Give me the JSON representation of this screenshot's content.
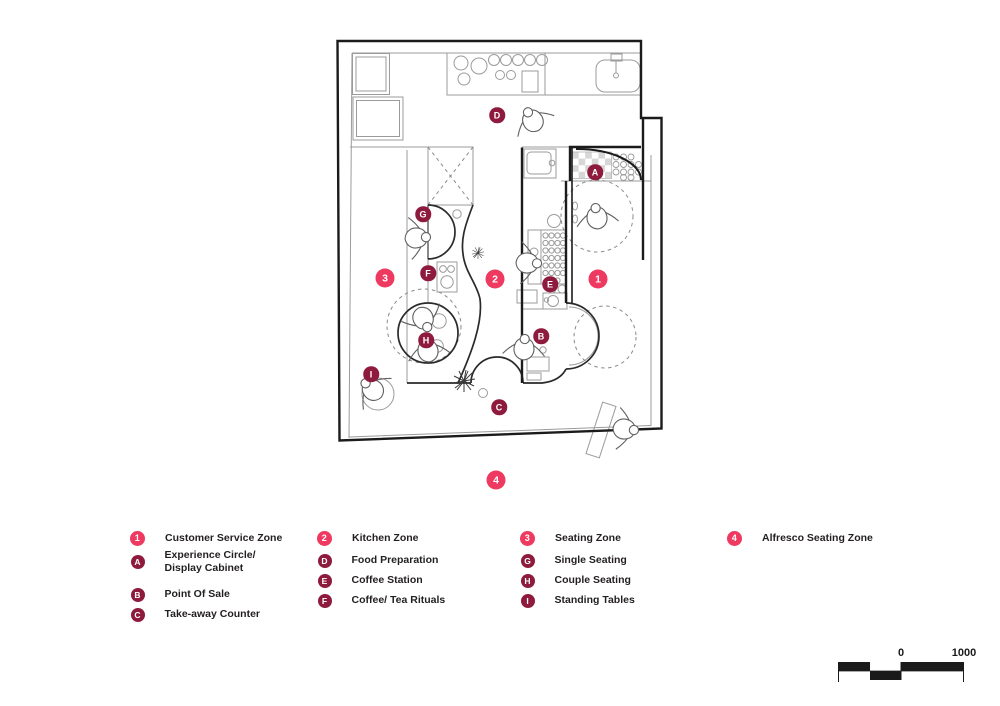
{
  "colors": {
    "zone_number_marker": "#EE3A60",
    "zone_letter_marker": "#8E1B3D",
    "wall": "#1b1b1b",
    "thin_line": "#9b9b9b"
  },
  "plan": {
    "markers": [
      {
        "label": "1",
        "type": "number",
        "x": 598,
        "y": 279
      },
      {
        "label": "2",
        "type": "number",
        "x": 495,
        "y": 279
      },
      {
        "label": "3",
        "type": "number",
        "x": 385,
        "y": 278
      },
      {
        "label": "4",
        "type": "number",
        "x": 496,
        "y": 480
      },
      {
        "label": "A",
        "type": "letter",
        "x": 595,
        "y": 172
      },
      {
        "label": "B",
        "type": "letter",
        "x": 541,
        "y": 336
      },
      {
        "label": "C",
        "type": "letter",
        "x": 499,
        "y": 407
      },
      {
        "label": "D",
        "type": "letter",
        "x": 497,
        "y": 115
      },
      {
        "label": "E",
        "type": "letter",
        "x": 550,
        "y": 284
      },
      {
        "label": "F",
        "type": "letter",
        "x": 428,
        "y": 273
      },
      {
        "label": "G",
        "type": "letter",
        "x": 423,
        "y": 214
      },
      {
        "label": "H",
        "type": "letter",
        "x": 426,
        "y": 340
      },
      {
        "label": "I",
        "type": "letter",
        "x": 371,
        "y": 374
      }
    ]
  },
  "legend": {
    "columns": [
      {
        "header": {
          "id": "1",
          "label": "Customer Service Zone"
        },
        "items": [
          {
            "id": "A",
            "label": "Experience Circle/",
            "label2": "Display Cabinet"
          },
          {
            "id": "B",
            "label": "Point Of Sale"
          },
          {
            "id": "C",
            "label": "Take-away Counter"
          }
        ]
      },
      {
        "header": {
          "id": "2",
          "label": "Kitchen Zone"
        },
        "items": [
          {
            "id": "D",
            "label": "Food Preparation"
          },
          {
            "id": "E",
            "label": "Coffee Station"
          },
          {
            "id": "F",
            "label": "Coffee/ Tea Rituals"
          }
        ]
      },
      {
        "header": {
          "id": "3",
          "label": "Seating Zone"
        },
        "items": [
          {
            "id": "G",
            "label": "Single Seating"
          },
          {
            "id": "H",
            "label": "Couple Seating"
          },
          {
            "id": "I",
            "label": "Standing Tables"
          }
        ]
      },
      {
        "header": {
          "id": "4",
          "label": "Alfresco Seating Zone"
        },
        "items": []
      }
    ]
  },
  "scale_bar": {
    "tick_zero": "0",
    "tick_max": "1000"
  }
}
